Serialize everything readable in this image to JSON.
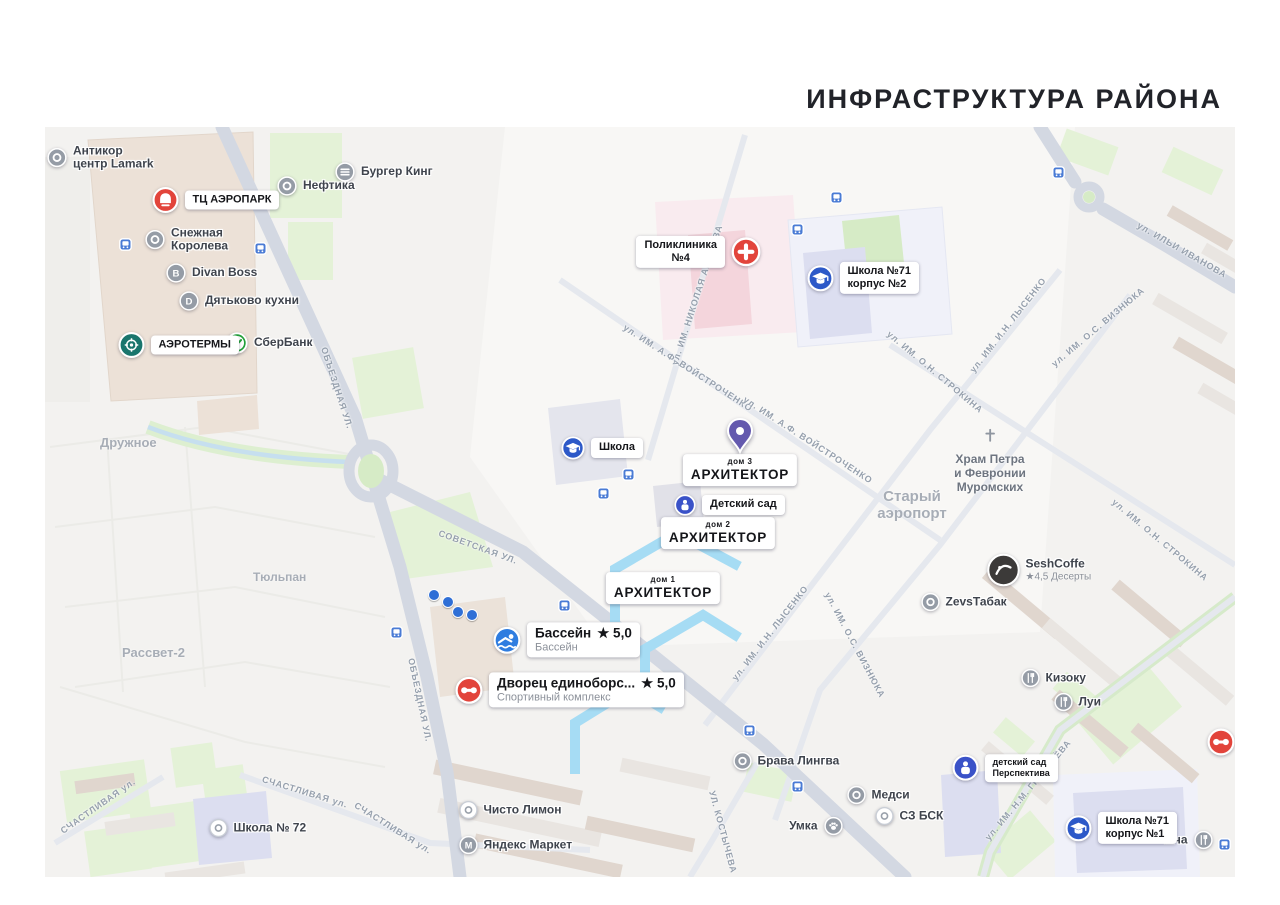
{
  "title": "ИНФРАСТРУКТУРА РАЙОНА",
  "colors": {
    "red": "#e2443b",
    "school_blue": "#2d59c8",
    "kid_blue": "#3a52c8",
    "pool_blue": "#2f7de0",
    "teal": "#19756d",
    "gray": "#959ca6",
    "dark": "#3c3a39",
    "sber_green": "#21a038",
    "purple": "#6459ae",
    "bus_blue": "#4a7bd5",
    "building_highlight": "#a6dcf4"
  },
  "map": {
    "area_labels": [
      {
        "text": "Дружное",
        "x": 100,
        "y": 443,
        "size": 13
      },
      {
        "text": "Тюльпан",
        "x": 253,
        "y": 578,
        "size": 12
      },
      {
        "text": "Рассвет-2",
        "x": 122,
        "y": 653,
        "size": 13
      },
      {
        "text": "Старый\nаэропорт",
        "x": 912,
        "y": 505,
        "size": 15,
        "center": true
      }
    ],
    "street_labels": [
      {
        "text": "ОБЪЕЗДНАЯ УЛ.",
        "x": 337,
        "y": 388,
        "rot": 72
      },
      {
        "text": "ОБЪЕЗДНАЯ УЛ.",
        "x": 420,
        "y": 700,
        "rot": 78
      },
      {
        "text": "СОВЕТСКАЯ УЛ.",
        "x": 478,
        "y": 547,
        "rot": 20
      },
      {
        "text": "ул. ИМ. НИКОЛАЯ АМОСОВА",
        "x": 697,
        "y": 295,
        "rot": -72
      },
      {
        "text": "ул. ИМ. А.Ф. ВОЙСТРОЧЕНКО",
        "x": 688,
        "y": 368,
        "rot": 33
      },
      {
        "text": "ул. ИМ. А.Ф. ВОЙСТРОЧЕНКО",
        "x": 808,
        "y": 440,
        "rot": 33
      },
      {
        "text": "ул. ИМ. И.Н. ЛЫСЕНКО",
        "x": 1008,
        "y": 325,
        "rot": -52
      },
      {
        "text": "ул. ИМ. И.Н. ЛЫСЕНКО",
        "x": 770,
        "y": 633,
        "rot": -52
      },
      {
        "text": "ул. ИМ. О.Н. СТРОКИНА",
        "x": 935,
        "y": 372,
        "rot": 40
      },
      {
        "text": "ул. ИМ. О.Н. СТРОКИНА",
        "x": 1160,
        "y": 540,
        "rot": 40
      },
      {
        "text": "ул. ИМ. О.С. ВИЗНЮКА",
        "x": 1098,
        "y": 327,
        "rot": -40
      },
      {
        "text": "ул. ИМ. О.С. ВИЗНЮКА",
        "x": 855,
        "y": 645,
        "rot": 62
      },
      {
        "text": "ул. ИЛЬИ ИВАНОВА",
        "x": 1182,
        "y": 250,
        "rot": 30
      },
      {
        "text": "СЧАСТЛИВАЯ ул.",
        "x": 305,
        "y": 792,
        "rot": 17
      },
      {
        "text": "СЧАСТЛИВАЯ ул.",
        "x": 393,
        "y": 828,
        "rot": 32
      },
      {
        "text": "СЧАСТЛИВАЯ ул.",
        "x": 98,
        "y": 806,
        "rot": -35
      },
      {
        "text": "УЛ. КОСТЫЧЕВА",
        "x": 723,
        "y": 832,
        "rot": 75
      },
      {
        "text": "ул. ИМ. Н.М. ГРИБАЧЁВА",
        "x": 1028,
        "y": 790,
        "rot": -50
      }
    ],
    "pois": [
      {
        "name": "poi-antikor-lamark",
        "icon": "ring",
        "color": "gray",
        "d": 20,
        "x": 57,
        "y": 158,
        "lines": [
          "Антикор",
          "центр Lamark"
        ]
      },
      {
        "name": "poi-burger-king",
        "icon": "burger",
        "color": "gray",
        "d": 20,
        "x": 345,
        "y": 172,
        "label": "Бургер Кинг"
      },
      {
        "name": "poi-neftika",
        "icon": "ring",
        "color": "gray",
        "d": 20,
        "x": 287,
        "y": 186,
        "label": "Нефтика"
      },
      {
        "name": "poi-snezhnaya-koroleva",
        "icon": "ring",
        "color": "gray",
        "d": 20,
        "x": 155,
        "y": 240,
        "lines": [
          "Снежная",
          "Королева"
        ]
      },
      {
        "name": "poi-divan-boss",
        "icon": "letter",
        "glyph": "B",
        "color": "gray",
        "d": 20,
        "x": 176,
        "y": 273,
        "label": "Divan Boss"
      },
      {
        "name": "poi-dyatkovo-kuhni",
        "icon": "letter",
        "glyph": "D",
        "color": "gray",
        "d": 20,
        "x": 189,
        "y": 301,
        "label": "Дятьково кухни"
      },
      {
        "name": "poi-sberbank",
        "icon": "check",
        "color": "sber_green",
        "d": 22,
        "x": 237,
        "y": 343,
        "label": "СберБанк"
      },
      {
        "name": "poi-tc-aeropark",
        "icon": "bell",
        "color": "red",
        "d": 27,
        "x": 165,
        "y": 200,
        "pill": true,
        "label": "ТЦ АЭРОПАРК"
      },
      {
        "name": "poi-aerotermy",
        "icon": "spa",
        "color": "teal",
        "d": 27,
        "x": 131,
        "y": 345,
        "pill": true,
        "label": "АЭРОТЕРМЫ"
      },
      {
        "name": "poi-poliklinika-4",
        "icon": "plus",
        "color": "red",
        "d": 30,
        "x": 746,
        "y": 252,
        "pill": true,
        "side": "left",
        "center": true,
        "lines": [
          "Поликлиника",
          "№4"
        ]
      },
      {
        "name": "poi-school-71-k2",
        "icon": "cap",
        "color": "school_blue",
        "d": 27,
        "x": 820,
        "y": 278,
        "pill": true,
        "lines": [
          "Школа №71",
          "корпус №2"
        ]
      },
      {
        "name": "poi-school",
        "icon": "cap",
        "color": "school_blue",
        "d": 24,
        "x": 573,
        "y": 448,
        "pill": true,
        "label": "Школа"
      },
      {
        "name": "poi-detsky-sad",
        "icon": "kid",
        "color": "kid_blue",
        "d": 22,
        "x": 685,
        "y": 505,
        "pill": true,
        "label": "Детский сад"
      },
      {
        "name": "poi-bassein",
        "icon": "pool",
        "color": "pool_blue",
        "d": 28,
        "x": 507,
        "y": 640,
        "pill": true,
        "title": "Бассейн",
        "rating": "★ 5,0",
        "sub": "Бассейн"
      },
      {
        "name": "poi-dvorets-edinoborstv",
        "icon": "dumb",
        "color": "red",
        "d": 28,
        "x": 469,
        "y": 690,
        "pill": true,
        "title": "Дворец единоборс...",
        "rating": "★ 5,0",
        "sub": "Спортивный комплекс"
      },
      {
        "name": "poi-hram",
        "icon": "church",
        "color": "gray",
        "d": 22,
        "x": 990,
        "y": 437,
        "stack": true,
        "lines": [
          "Храм Петра",
          "и Февронии",
          "Муромских"
        ]
      },
      {
        "name": "poi-seshcoffe",
        "icon": "dark-logo",
        "color": "dark",
        "d": 33,
        "x": 1003,
        "y": 570,
        "label": "SeshCoffe",
        "sub": "★4,5 Десерты"
      },
      {
        "name": "poi-zevstabak",
        "icon": "ring",
        "color": "gray",
        "d": 19,
        "x": 930,
        "y": 602,
        "label": "ZevsТабак"
      },
      {
        "name": "poi-kizoku",
        "icon": "fork",
        "color": "gray",
        "d": 19,
        "x": 1030,
        "y": 678,
        "label": "Кизоку"
      },
      {
        "name": "poi-lui",
        "icon": "fork",
        "color": "gray",
        "d": 19,
        "x": 1063,
        "y": 702,
        "label": "Луи"
      },
      {
        "name": "poi-brava-lingva",
        "icon": "ring",
        "color": "gray",
        "d": 19,
        "x": 742,
        "y": 761,
        "label": "Брава Лингва"
      },
      {
        "name": "poi-medsi",
        "icon": "ring",
        "color": "gray",
        "d": 19,
        "x": 856,
        "y": 795,
        "label": "Медси"
      },
      {
        "name": "poi-sz-bsk",
        "icon": "ring-light",
        "color": "gray",
        "d": 19,
        "x": 884,
        "y": 816,
        "label": "СЗ БСК"
      },
      {
        "name": "poi-umka",
        "icon": "paw",
        "color": "gray",
        "d": 19,
        "x": 833,
        "y": 826,
        "side": "left",
        "label": "Умка"
      },
      {
        "name": "poi-chisto-limon",
        "icon": "ring-light",
        "color": "gray",
        "d": 19,
        "x": 468,
        "y": 810,
        "label": "Чисто Лимон"
      },
      {
        "name": "poi-yandex-market",
        "icon": "letter",
        "glyph": "M",
        "color": "gray",
        "d": 19,
        "x": 468,
        "y": 845,
        "label": "Яндекс Маркет"
      },
      {
        "name": "poi-school-72",
        "icon": "ring-light",
        "color": "gray",
        "d": 19,
        "x": 218,
        "y": 828,
        "label": "Школа № 72"
      },
      {
        "name": "poi-chacha",
        "icon": "fork",
        "color": "gray",
        "d": 19,
        "x": 1203,
        "y": 840,
        "side": "left",
        "label": "Чача"
      },
      {
        "name": "poi-detsad-perspektiva",
        "icon": "kid",
        "color": "kid_blue",
        "d": 27,
        "x": 965,
        "y": 768,
        "pill": true,
        "small": true,
        "lines": [
          "детский сад",
          "Перспектива"
        ]
      },
      {
        "name": "poi-school-71-k1",
        "icon": "cap",
        "color": "school_blue",
        "d": 27,
        "x": 1078,
        "y": 828,
        "pill": true,
        "lines": [
          "Школа №71",
          "корпус №1"
        ]
      },
      {
        "name": "poi-sport-edge",
        "icon": "dumb",
        "color": "red",
        "d": 28,
        "x": 1221,
        "y": 742
      }
    ],
    "houses": [
      {
        "name": "house-3",
        "top": "дом 3",
        "big": "АРХИТЕКТОР",
        "x": 740,
        "y": 470,
        "pin": {
          "x": 740,
          "y": 432
        }
      },
      {
        "name": "house-2",
        "top": "дом 2",
        "big": "АРХИТЕКТОР",
        "x": 718,
        "y": 533
      },
      {
        "name": "house-1",
        "top": "дом 1",
        "big": "АРХИТЕКТОР",
        "x": 663,
        "y": 588
      }
    ],
    "bus_stops": [
      [
        125,
        244
      ],
      [
        260,
        248
      ],
      [
        836,
        197
      ],
      [
        797,
        229
      ],
      [
        628,
        474
      ],
      [
        603,
        493
      ],
      [
        564,
        605
      ],
      [
        396,
        632
      ],
      [
        749,
        730
      ],
      [
        797,
        786
      ],
      [
        1058,
        172
      ],
      [
        1224,
        844
      ]
    ],
    "dots": [
      [
        433,
        594
      ],
      [
        447,
        601
      ],
      [
        457,
        611
      ],
      [
        471,
        614
      ]
    ]
  }
}
